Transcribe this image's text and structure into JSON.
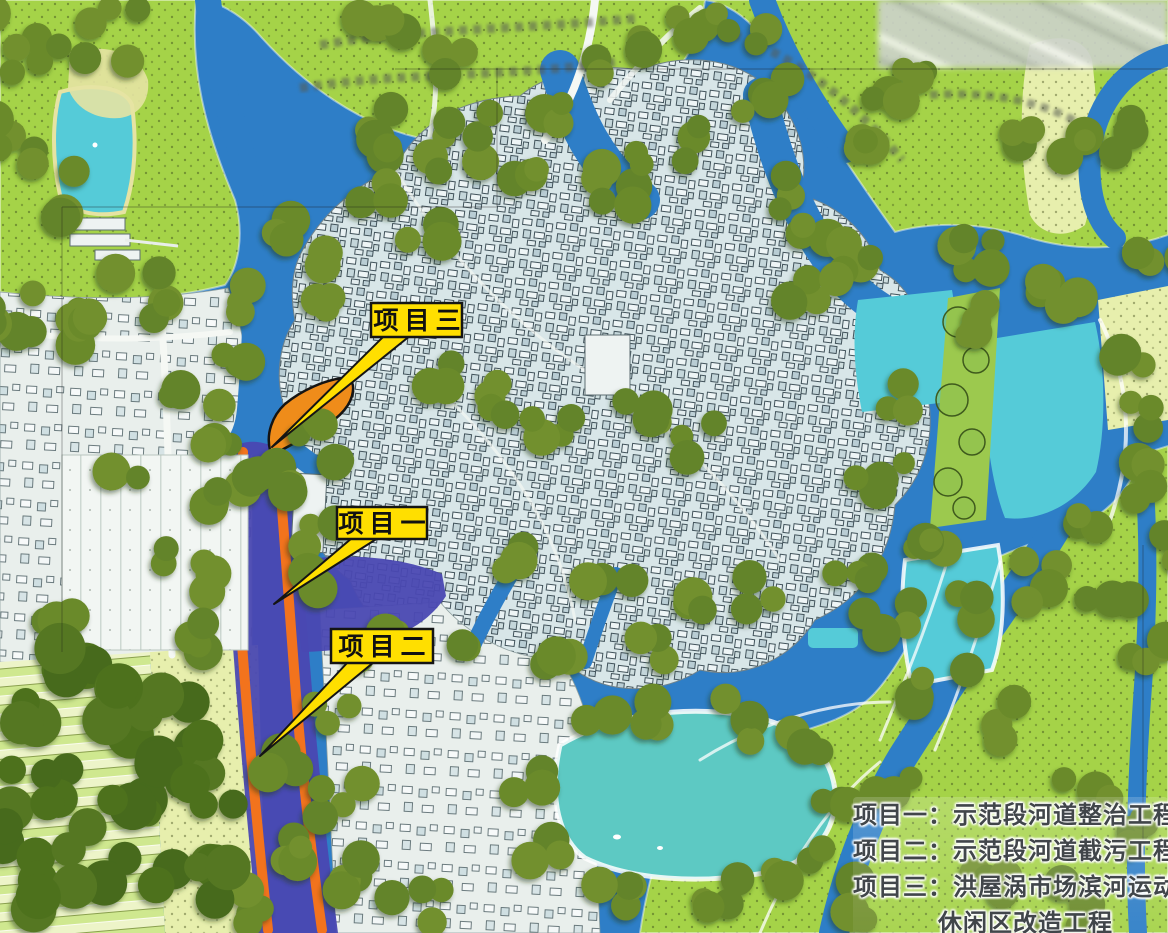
{
  "callouts": [
    {
      "id": "project-3",
      "label": "项目三"
    },
    {
      "id": "project-1",
      "label": "项目一"
    },
    {
      "id": "project-2",
      "label": "项目二"
    }
  ],
  "legend": {
    "rows": [
      {
        "text": "项目一：示范段河道整治工程",
        "indent": false
      },
      {
        "text": "项目二：示范段河道截污工程",
        "indent": false
      },
      {
        "text": "项目三：洪屋涡市场滨河运动",
        "indent": false
      },
      {
        "text": "休闲区改造工程",
        "indent": true
      }
    ]
  },
  "theme": {
    "water": "#2e7ec7",
    "pond_cyan": "#55cbd8",
    "pond_teal": "#5dc9c3",
    "field_green": "#a5d348",
    "field_pale": "#e7efad",
    "urban": "#d8e6e8",
    "urban_west": "#e9efec",
    "tree": "#6b8a2b",
    "tree_dark": "#4e711f",
    "demo_river": "#4a48b2",
    "bank_orange": "#f2731d",
    "site_orange": "#ef8c1a",
    "callout_yellow": "#ffdf00",
    "callout_border": "#141414",
    "legend_text": "#41464a",
    "legend_halo": "#ffffff"
  }
}
